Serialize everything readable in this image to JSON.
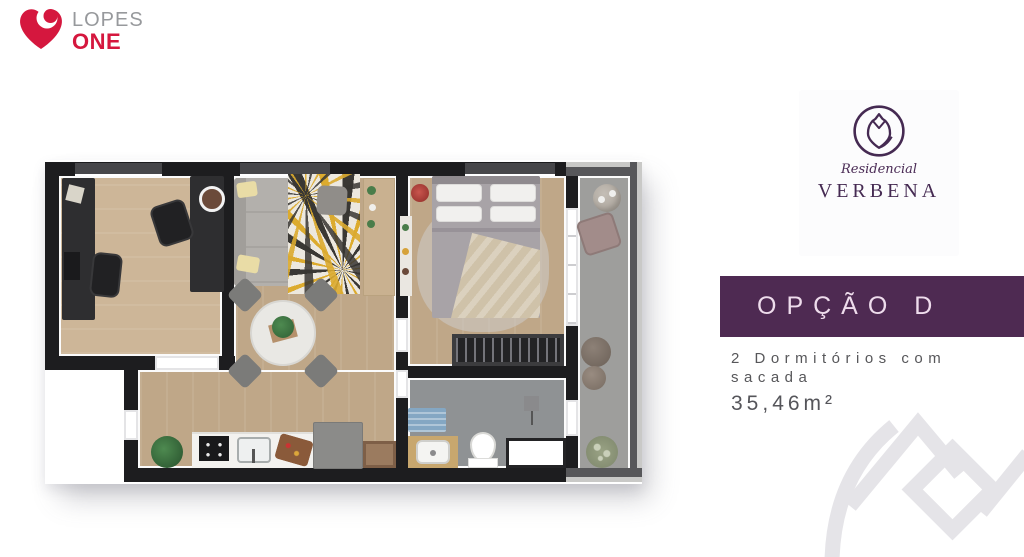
{
  "brand": {
    "name_top": "LOPES",
    "name_bottom": "ONE",
    "heart_color": "#d5173e",
    "name_top_color": "#97999c"
  },
  "development": {
    "script_label": "Residencial",
    "name": "VERBENA",
    "logo_color": "#452a52",
    "logo_icon": "verbena-tulip-circle-icon"
  },
  "option": {
    "label": "OPÇÃO D",
    "banner_color": "#4e2a52",
    "text_color": "#eedcec"
  },
  "details": {
    "line1": "2 Dormitórios com",
    "line2": "sacada",
    "area": "35,46m²",
    "text_color": "#57575a"
  },
  "floor_plan": {
    "type": "apartment-top-view-render",
    "rooms": [
      "office",
      "living-dining-room",
      "kitchen",
      "bedroom",
      "closet",
      "bathroom",
      "balcony"
    ],
    "wall_color": "#1d1d1f",
    "wood_floor_color": "#bfa788",
    "balcony_floor_color": "#9e9e9c"
  },
  "watermark": {
    "icon": "verbena-tulip-monogram",
    "color": "#e5e4e8"
  }
}
